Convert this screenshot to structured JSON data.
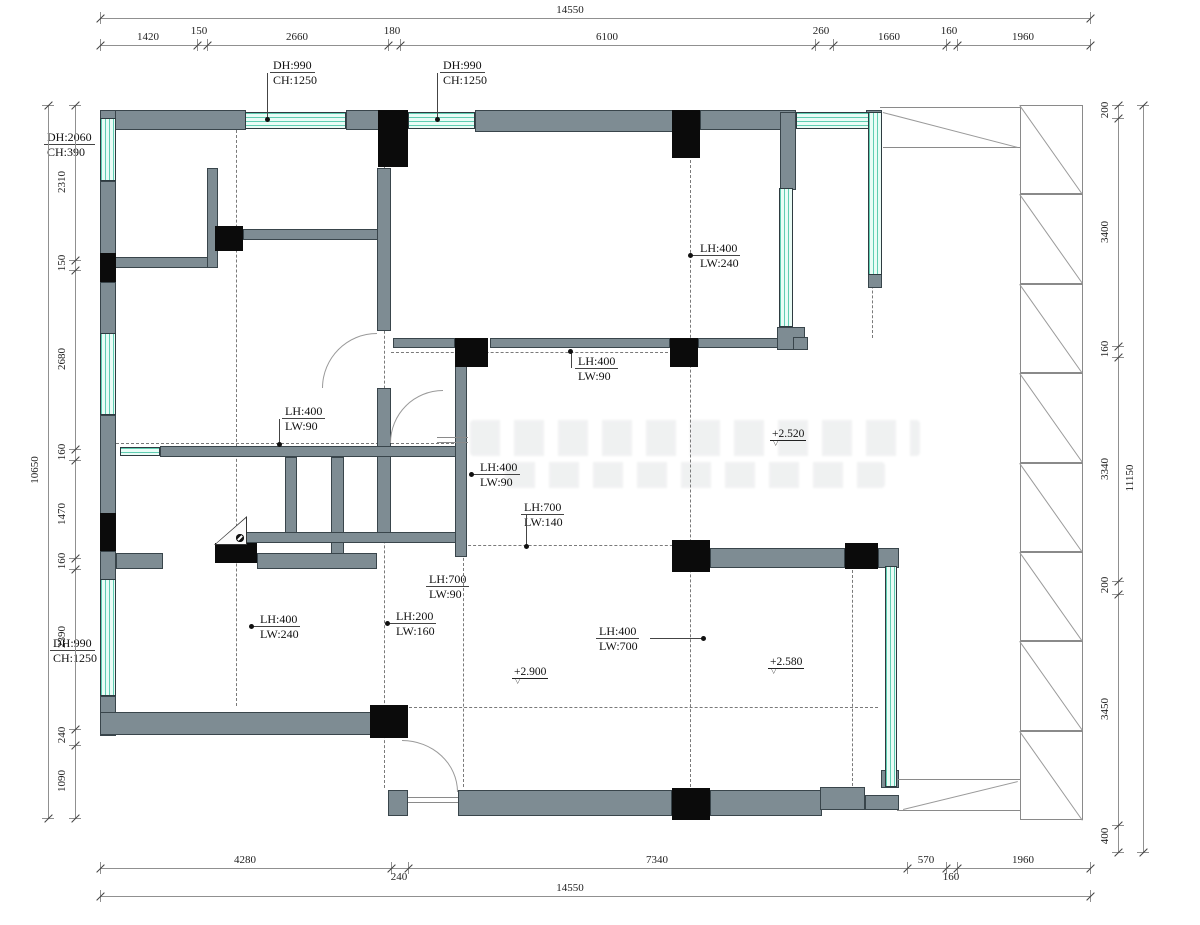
{
  "title": "floor-plan-drawing",
  "colors": {
    "wall": "#7e8c93",
    "column": "#0b0b0b",
    "window_bg": "#e9fcf6",
    "window_line": "#5fcdb2",
    "dim": "#909090",
    "text": "#1a1a1a"
  },
  "levels": [
    {
      "text": "+2.520",
      "x": 770,
      "y": 428
    },
    {
      "text": "+2.900",
      "x": 512,
      "y": 666
    },
    {
      "text": "+2.580",
      "x": 768,
      "y": 656
    }
  ],
  "tags": [
    {
      "lines": [
        "DH:990",
        "CH:1250"
      ],
      "lx": 270,
      "ly": 58,
      "dot": {
        "x": 267,
        "y": 119
      },
      "conn": {
        "x": 267,
        "y": 73,
        "w": 1,
        "h": 46
      }
    },
    {
      "lines": [
        "DH:990",
        "CH:1250"
      ],
      "lx": 440,
      "ly": 58,
      "dot": {
        "x": 437,
        "y": 119
      },
      "conn": {
        "x": 437,
        "y": 73,
        "w": 1,
        "h": 46
      }
    },
    {
      "lines": [
        "DH:2060",
        "CH:390"
      ],
      "lx": 44,
      "ly": 130
    },
    {
      "lines": [
        "LH:400",
        "LW:240"
      ],
      "lx": 697,
      "ly": 241,
      "dot": {
        "x": 690,
        "y": 255
      },
      "conn": {
        "x": 691,
        "y": 255,
        "w": 7,
        "h": 1
      }
    },
    {
      "lines": [
        "LH:400",
        "LW:90"
      ],
      "lx": 575,
      "ly": 354,
      "dot": {
        "x": 570,
        "y": 351
      },
      "conn": {
        "x": 571,
        "y": 352,
        "w": 1,
        "h": 16
      }
    },
    {
      "lines": [
        "LH:400",
        "LW:90"
      ],
      "lx": 282,
      "ly": 404,
      "dot": {
        "x": 279,
        "y": 444
      },
      "conn": {
        "x": 279,
        "y": 419,
        "w": 1,
        "h": 25
      }
    },
    {
      "lines": [
        "LH:400",
        "LW:90"
      ],
      "lx": 477,
      "ly": 460,
      "dot": {
        "x": 471,
        "y": 474
      },
      "conn": {
        "x": 472,
        "y": 474,
        "w": 6,
        "h": 1
      }
    },
    {
      "lines": [
        "LH:700",
        "LW:140"
      ],
      "lx": 521,
      "ly": 500,
      "dot": {
        "x": 526,
        "y": 546
      },
      "conn": {
        "x": 526,
        "y": 515,
        "w": 1,
        "h": 31
      }
    },
    {
      "lines": [
        "LH:700",
        "LW:90"
      ],
      "lx": 426,
      "ly": 572
    },
    {
      "lines": [
        "LH:400",
        "LW:240"
      ],
      "lx": 257,
      "ly": 612,
      "dot": {
        "x": 251,
        "y": 626
      },
      "conn": {
        "x": 252,
        "y": 626,
        "w": 6,
        "h": 1
      }
    },
    {
      "lines": [
        "LH:200",
        "LW:160"
      ],
      "lx": 393,
      "ly": 609,
      "dot": {
        "x": 387,
        "y": 623
      },
      "conn": {
        "x": 388,
        "y": 623,
        "w": 6,
        "h": 1
      }
    },
    {
      "lines": [
        "LH:400",
        "LW:700"
      ],
      "lx": 596,
      "ly": 624,
      "dot": {
        "x": 703,
        "y": 638
      },
      "conn": {
        "x": 650,
        "y": 638,
        "w": 53,
        "h": 1
      }
    },
    {
      "lines": [
        "DH:990",
        "CH:1250"
      ],
      "lx": 50,
      "ly": 636
    }
  ],
  "dims": [
    {
      "orient": "h",
      "line": 18,
      "boundaries": [
        100,
        1090
      ],
      "labels": [
        {
          "text": "14550",
          "at": 570
        }
      ]
    },
    {
      "orient": "h",
      "line": 45,
      "boundaries": [
        100,
        197,
        207,
        388,
        400,
        815,
        833,
        946,
        957,
        1090
      ],
      "labels": [
        {
          "text": "1420",
          "at": 148
        },
        {
          "text": "150",
          "at": 199,
          "raised": true
        },
        {
          "text": "2660",
          "at": 297
        },
        {
          "text": "180",
          "at": 392,
          "raised": true
        },
        {
          "text": "6100",
          "at": 607
        },
        {
          "text": "260",
          "at": 821,
          "raised": true
        },
        {
          "text": "1660",
          "at": 889
        },
        {
          "text": "160",
          "at": 949,
          "raised": true
        },
        {
          "text": "1960",
          "at": 1023
        }
      ]
    },
    {
      "orient": "h",
      "line": 868,
      "boundaries": [
        100,
        391,
        408,
        907,
        946,
        957,
        1090
      ],
      "labels": [
        {
          "text": "4280",
          "at": 245
        },
        {
          "text": "240",
          "at": 399,
          "below": true
        },
        {
          "text": "7340",
          "at": 657
        },
        {
          "text": "570",
          "at": 926
        },
        {
          "text": "160",
          "at": 951,
          "below": true
        },
        {
          "text": "1960",
          "at": 1023
        }
      ]
    },
    {
      "orient": "h",
      "line": 896,
      "boundaries": [
        100,
        1090
      ],
      "labels": [
        {
          "text": "14550",
          "at": 570
        }
      ]
    },
    {
      "orient": "v",
      "line": 75,
      "boundaries": [
        105,
        260,
        270,
        449,
        460,
        558,
        569,
        729,
        745,
        818
      ],
      "labels": [
        {
          "text": "2310",
          "at": 182
        },
        {
          "text": "150",
          "at": 263,
          "raised": true
        },
        {
          "text": "2680",
          "at": 359
        },
        {
          "text": "160",
          "at": 452,
          "raised": true
        },
        {
          "text": "1470",
          "at": 514
        },
        {
          "text": "160",
          "at": 561,
          "raised": true
        },
        {
          "text": "2390",
          "at": 637
        },
        {
          "text": "240",
          "at": 735,
          "raised": true
        },
        {
          "text": "1090",
          "at": 781
        }
      ]
    },
    {
      "orient": "v",
      "line": 48,
      "boundaries": [
        105,
        818
      ],
      "labels": [
        {
          "text": "10650",
          "at": 470
        }
      ]
    },
    {
      "orient": "v",
      "line": 1118,
      "boundaries": [
        105,
        118,
        346,
        357,
        581,
        594,
        825,
        852
      ],
      "labels": [
        {
          "text": "200",
          "at": 110,
          "raised": true
        },
        {
          "text": "3400",
          "at": 232
        },
        {
          "text": "160",
          "at": 349,
          "raised": true
        },
        {
          "text": "3340",
          "at": 469
        },
        {
          "text": "200",
          "at": 585,
          "raised": true
        },
        {
          "text": "3450",
          "at": 709
        },
        {
          "text": "400",
          "at": 836,
          "raised": true
        }
      ]
    },
    {
      "orient": "v",
      "line": 1143,
      "boundaries": [
        105,
        852
      ],
      "labels": [
        {
          "text": "11150",
          "at": 478
        }
      ]
    }
  ],
  "plan": {
    "walls": [
      {
        "x": 100,
        "y": 110,
        "w": 146,
        "h": 20
      },
      {
        "x": 346,
        "y": 110,
        "w": 34,
        "h": 20
      },
      {
        "x": 475,
        "y": 110,
        "w": 201,
        "h": 22
      },
      {
        "x": 700,
        "y": 110,
        "w": 96,
        "h": 20
      },
      {
        "x": 780,
        "y": 112,
        "w": 16,
        "h": 78
      },
      {
        "x": 100,
        "y": 110,
        "w": 16,
        "h": 9
      },
      {
        "x": 100,
        "y": 181,
        "w": 16,
        "h": 73
      },
      {
        "x": 100,
        "y": 282,
        "w": 16,
        "h": 52
      },
      {
        "x": 100,
        "y": 415,
        "w": 16,
        "h": 99
      },
      {
        "x": 100,
        "y": 551,
        "w": 16,
        "h": 29
      },
      {
        "x": 100,
        "y": 696,
        "w": 16,
        "h": 40
      },
      {
        "x": 100,
        "y": 712,
        "w": 274,
        "h": 23
      },
      {
        "x": 115,
        "y": 257,
        "w": 93,
        "h": 11
      },
      {
        "x": 207,
        "y": 168,
        "w": 11,
        "h": 100
      },
      {
        "x": 243,
        "y": 229,
        "w": 136,
        "h": 11
      },
      {
        "x": 377,
        "y": 168,
        "w": 14,
        "h": 163
      },
      {
        "x": 377,
        "y": 388,
        "w": 14,
        "h": 154
      },
      {
        "x": 160,
        "y": 446,
        "w": 296,
        "h": 11
      },
      {
        "x": 285,
        "y": 457,
        "w": 12,
        "h": 76
      },
      {
        "x": 331,
        "y": 457,
        "w": 13,
        "h": 100
      },
      {
        "x": 243,
        "y": 532,
        "w": 217,
        "h": 11
      },
      {
        "x": 116,
        "y": 553,
        "w": 47,
        "h": 16
      },
      {
        "x": 257,
        "y": 553,
        "w": 120,
        "h": 16
      },
      {
        "x": 455,
        "y": 348,
        "w": 12,
        "h": 209
      },
      {
        "x": 393,
        "y": 338,
        "w": 62,
        "h": 10
      },
      {
        "x": 490,
        "y": 338,
        "w": 180,
        "h": 10
      },
      {
        "x": 698,
        "y": 338,
        "w": 80,
        "h": 10
      },
      {
        "x": 777,
        "y": 327,
        "w": 28,
        "h": 23
      },
      {
        "x": 793,
        "y": 337,
        "w": 15,
        "h": 13
      },
      {
        "x": 710,
        "y": 548,
        "w": 135,
        "h": 20
      },
      {
        "x": 878,
        "y": 548,
        "w": 21,
        "h": 20
      },
      {
        "x": 866,
        "y": 110,
        "w": 16,
        "h": 8
      },
      {
        "x": 868,
        "y": 274,
        "w": 14,
        "h": 14
      },
      {
        "x": 881,
        "y": 770,
        "w": 18,
        "h": 18
      },
      {
        "x": 458,
        "y": 790,
        "w": 214,
        "h": 26
      },
      {
        "x": 710,
        "y": 790,
        "w": 112,
        "h": 26
      },
      {
        "x": 388,
        "y": 790,
        "w": 20,
        "h": 26
      },
      {
        "x": 820,
        "y": 787,
        "w": 45,
        "h": 23
      },
      {
        "x": 865,
        "y": 795,
        "w": 34,
        "h": 15
      }
    ],
    "columns": [
      {
        "x": 378,
        "y": 110,
        "w": 30,
        "h": 57
      },
      {
        "x": 672,
        "y": 110,
        "w": 28,
        "h": 48
      },
      {
        "x": 455,
        "y": 338,
        "w": 33,
        "h": 29
      },
      {
        "x": 670,
        "y": 338,
        "w": 28,
        "h": 29
      },
      {
        "x": 672,
        "y": 540,
        "w": 38,
        "h": 32
      },
      {
        "x": 845,
        "y": 543,
        "w": 33,
        "h": 26
      },
      {
        "x": 370,
        "y": 705,
        "w": 38,
        "h": 33
      },
      {
        "x": 672,
        "y": 788,
        "w": 38,
        "h": 32
      },
      {
        "x": 215,
        "y": 226,
        "w": 28,
        "h": 25
      },
      {
        "x": 215,
        "y": 543,
        "w": 42,
        "h": 20
      },
      {
        "x": 100,
        "y": 253,
        "w": 16,
        "h": 29
      },
      {
        "x": 100,
        "y": 513,
        "w": 16,
        "h": 38
      }
    ],
    "windows": [
      {
        "x": 245,
        "y": 112,
        "w": 101,
        "h": 17
      },
      {
        "x": 408,
        "y": 112,
        "w": 67,
        "h": 17
      },
      {
        "x": 796,
        "y": 112,
        "w": 84,
        "h": 17
      },
      {
        "x": 868,
        "y": 112,
        "w": 14,
        "h": 163
      },
      {
        "x": 100,
        "y": 118,
        "w": 16,
        "h": 63
      },
      {
        "x": 100,
        "y": 333,
        "w": 16,
        "h": 82
      },
      {
        "x": 100,
        "y": 579,
        "w": 16,
        "h": 117
      },
      {
        "x": 779,
        "y": 188,
        "w": 14,
        "h": 139
      },
      {
        "x": 885,
        "y": 566,
        "w": 12,
        "h": 221
      },
      {
        "x": 120,
        "y": 447,
        "w": 40,
        "h": 9
      }
    ],
    "dash_v": [
      {
        "x": 236,
        "y1": 130,
        "y2": 706
      },
      {
        "x": 384,
        "y1": 166,
        "y2": 788
      },
      {
        "x": 463,
        "y1": 367,
        "y2": 787
      },
      {
        "x": 690,
        "y1": 160,
        "y2": 787
      },
      {
        "x": 852,
        "y1": 570,
        "y2": 786
      },
      {
        "x": 872,
        "y1": 142,
        "y2": 338
      }
    ],
    "dash_h": [
      {
        "y": 352,
        "x1": 391,
        "x2": 668
      },
      {
        "y": 443,
        "x1": 116,
        "x2": 454
      },
      {
        "y": 545,
        "x1": 463,
        "x2": 688
      },
      {
        "y": 707,
        "x1": 404,
        "x2": 878
      }
    ],
    "thin": [
      {
        "x": 880,
        "y": 107,
        "w": 140,
        "h": 1
      },
      {
        "x": 883,
        "y": 147,
        "w": 137,
        "h": 1
      },
      {
        "x": 897,
        "y": 779,
        "w": 123,
        "h": 1
      },
      {
        "x": 897,
        "y": 810,
        "w": 123,
        "h": 1
      },
      {
        "x": 408,
        "y": 797,
        "w": 50,
        "h": 1
      },
      {
        "x": 408,
        "y": 802,
        "w": 50,
        "h": 1
      },
      {
        "x": 437,
        "y": 437,
        "w": 31,
        "h": 1
      },
      {
        "x": 437,
        "y": 442,
        "w": 31,
        "h": 1
      }
    ],
    "diagonals": [
      {
        "x1": 883,
        "y1": 112,
        "x2": 1018,
        "y2": 147
      },
      {
        "x1": 903,
        "y1": 809,
        "x2": 1018,
        "y2": 781
      }
    ],
    "strip": {
      "x": 1020,
      "y": 105,
      "w": 63,
      "h": 715,
      "sections": 8
    },
    "arcs": [
      {
        "x": 322,
        "y": 333,
        "w": 55,
        "h": 55,
        "corner": "tl"
      },
      {
        "x": 390,
        "y": 390,
        "w": 53,
        "h": 53,
        "corner": "tl"
      },
      {
        "x": 402,
        "y": 740,
        "w": 56,
        "h": 52,
        "corner": "tr"
      }
    ],
    "flue": {
      "x": 214,
      "y": 516,
      "w": 33,
      "h": 29,
      "fan_x": 236,
      "fan_y": 534
    },
    "watermarks": [
      {
        "x": 470,
        "y": 420,
        "w": 450,
        "h": 36
      },
      {
        "x": 505,
        "y": 462,
        "w": 380,
        "h": 26
      }
    ]
  }
}
